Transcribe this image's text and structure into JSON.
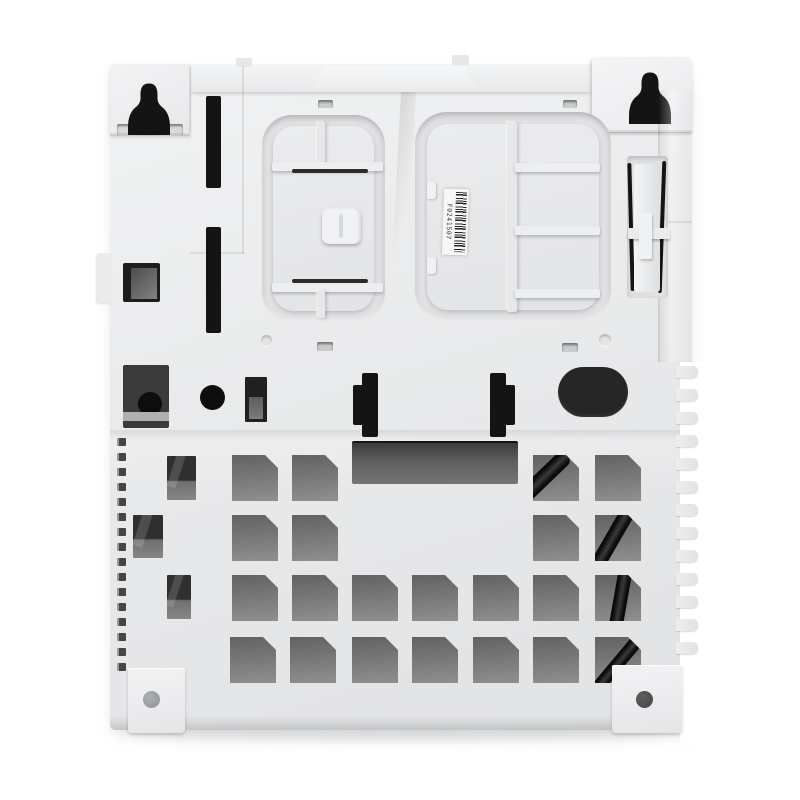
{
  "meta": {
    "subject": "Product photograph: rear exterior of a white plastic electronics enclosure (wall-mount housing) with keyhole mounting ears, snap-fit battery recesses, ventilation cutout grid, edge fins and a barcode sticker",
    "background_color": "#ffffff"
  },
  "label": {
    "type": "barcode-sticker",
    "text": "F0241507"
  },
  "palette": {
    "body_light": "#f1f2f3",
    "body_mid": "#e8e9eb",
    "body_dark": "#dfe1e3",
    "cutout_black": "#141414",
    "hole_top": "#626262",
    "hole_bottom": "#8f8f8f",
    "recess_shadow": "rgba(0,0,0,0.20)"
  },
  "figure": {
    "grid_holes": {
      "size": 46,
      "chamfer": 13,
      "holes": [
        {
          "x": 232,
          "y": 455
        },
        {
          "x": 292,
          "y": 455
        },
        {
          "x": 533,
          "y": 455,
          "cable": {
            "a": 46,
            "dx": -2,
            "w": 16
          }
        },
        {
          "x": 595,
          "y": 455
        },
        {
          "x": 232,
          "y": 515
        },
        {
          "x": 292,
          "y": 515
        },
        {
          "x": 533,
          "y": 515
        },
        {
          "x": 595,
          "y": 515,
          "cable": {
            "a": 30,
            "dx": 8,
            "w": 15
          }
        },
        {
          "x": 232,
          "y": 575
        },
        {
          "x": 292,
          "y": 575
        },
        {
          "x": 352,
          "y": 575
        },
        {
          "x": 412,
          "y": 575
        },
        {
          "x": 473,
          "y": 575
        },
        {
          "x": 533,
          "y": 575
        },
        {
          "x": 595,
          "y": 575,
          "cable": {
            "a": 10,
            "dx": 18,
            "w": 14
          }
        },
        {
          "x": 230,
          "y": 637
        },
        {
          "x": 290,
          "y": 637
        },
        {
          "x": 352,
          "y": 637
        },
        {
          "x": 412,
          "y": 637
        },
        {
          "x": 473,
          "y": 637
        },
        {
          "x": 533,
          "y": 637
        },
        {
          "x": 595,
          "y": 637,
          "cable": {
            "a": 40,
            "dx": 16,
            "w": 13
          }
        }
      ]
    },
    "narrow_holes": [
      {
        "x": 167,
        "y": 456,
        "w": 29,
        "h": 44
      },
      {
        "x": 133,
        "y": 515,
        "w": 30,
        "h": 43
      },
      {
        "x": 167,
        "y": 575,
        "w": 24,
        "h": 44
      }
    ],
    "left_vents": {
      "x": 117,
      "y0": 438,
      "step": 15,
      "count": 16,
      "w": 9,
      "h": 8
    },
    "right_fins": {
      "x": 676,
      "y0": 366,
      "step": 23,
      "count": 13,
      "w": 22,
      "h": 12
    }
  }
}
